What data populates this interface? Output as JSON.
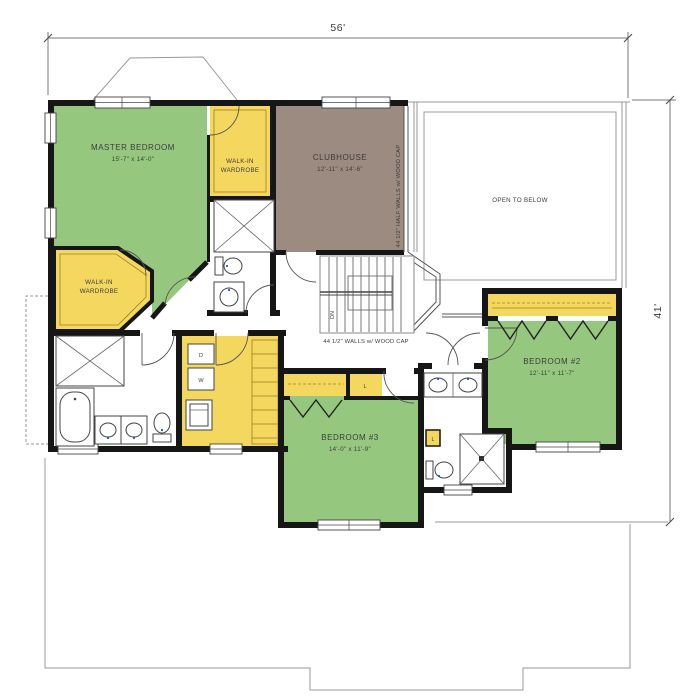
{
  "dimensions": {
    "width": "56'",
    "height": "41'"
  },
  "rooms": {
    "master": {
      "name": "MASTER BEDROOM",
      "size": "15'-7\" x 14'-0\""
    },
    "wiw1": {
      "line1": "WALK-IN",
      "line2": "WARDROBE"
    },
    "wiw2": {
      "line1": "WALK-IN",
      "line2": "WARDROBE"
    },
    "clubhouse": {
      "name": "CLUBHOUSE",
      "size": "12'-11\" x 14'-6\""
    },
    "open_below": {
      "name": "OPEN TO BELOW"
    },
    "bedroom2": {
      "name": "BEDROOM #2",
      "size": "12'-11\" x 11'-7\""
    },
    "bedroom3": {
      "name": "BEDROOM #3",
      "size": "14'-0\" x 11'-9\""
    }
  },
  "labels": {
    "stairs_dn": "DN",
    "dryer": "D",
    "washer": "W",
    "linen_hall": "L",
    "linen_bath": "L",
    "wall_note": "44 1/2\" WALLS w/ WOOD CAP",
    "half_wall_note": "44 1/2\" HALF WALLS w/ WOOD CAP"
  },
  "colors": {
    "bedroom_green": "#95c87e",
    "closet_yellow": "#f4d75e",
    "clubhouse_brown": "#9c8b80",
    "wall_black": "#161616",
    "line_gray": "#999999"
  }
}
